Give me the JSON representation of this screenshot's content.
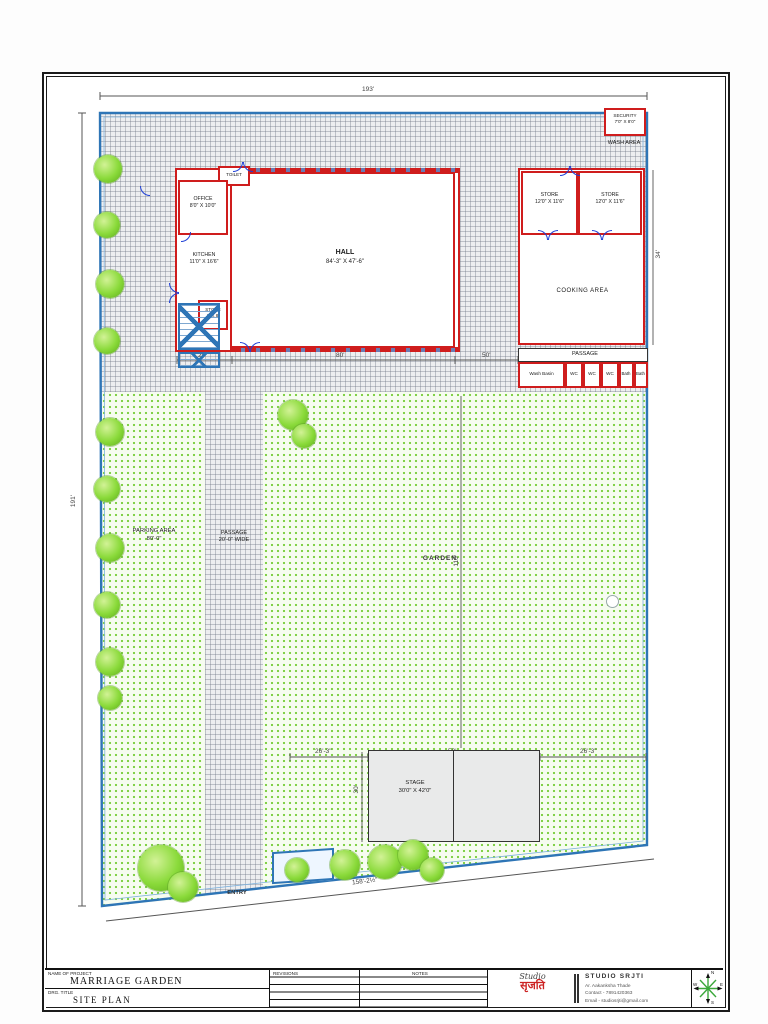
{
  "sheet": {
    "titleblock": {
      "project_label": "NAME OF PROJECT",
      "project_name": "MARRIAGE GARDEN",
      "drawing_label": "DRG. TITLE",
      "drawing_name": "SITE PLAN",
      "revisions_label": "REVISIONS",
      "notes_label": "NOTES",
      "logo_script": "Studio",
      "logo_devanagari": "सृजति",
      "firm_name": "STUDIO SRJTI",
      "architect": "Ar. Aakanksha Thade",
      "contact": "Contact - 7891420363",
      "email": "Email - studiosrjti@gmail.com"
    },
    "compass": {
      "n": "N",
      "e": "E",
      "s": "S",
      "w": "W"
    }
  },
  "plan": {
    "rooms": {
      "office": {
        "name": "OFFICE",
        "dims": "8'0\" X 10'0\""
      },
      "toilet": {
        "name": "TOILET"
      },
      "kitchen": {
        "name": "KITCHEN",
        "dims": "11'0\" X 16'6\""
      },
      "store_small": {
        "name": "STORE",
        "dims": "6' X 8'"
      },
      "hall": {
        "name": "HALL",
        "dims": "84'-3\" X 47'-6\""
      },
      "store_1": {
        "name": "STORE",
        "dims": "12'0\" X 11'6\""
      },
      "store_2": {
        "name": "STORE",
        "dims": "12'0\" X 11'6\""
      },
      "cooking": {
        "name": "COOKING AREA"
      },
      "passage_rear": {
        "name": "PASSAGE"
      },
      "wash_basin": {
        "name": "Wash Basin"
      },
      "wc_1": {
        "name": "WC"
      },
      "wc_2": {
        "name": "WC"
      },
      "wc_3": {
        "name": "WC"
      },
      "bath_1": {
        "name": "Bath"
      },
      "bath_2": {
        "name": "Bath"
      },
      "security": {
        "name": "SECURITY",
        "dims": "7'0\" X 8'0\""
      },
      "wash_area": {
        "name": "WASH AREA"
      },
      "parking": {
        "name": "PARKING AREA",
        "dims": "80'-0\""
      },
      "passage_main": {
        "name": "PASSAGE",
        "dims": "20'-0\" WIDE"
      },
      "garden": {
        "name": "GARDEN"
      },
      "stage": {
        "name": "STAGE",
        "dims": "30'0\" X 42'0\""
      },
      "entry": {
        "name": "ENTRY"
      }
    },
    "dims": {
      "top": "193'",
      "left": "191'",
      "bottom": "158'-2½\"",
      "hall_w": "84'-3\"",
      "hall_h": "47'-6\"",
      "cooking_w": "34'-3\"",
      "cooking_side": "34'",
      "under_a_left": "20'",
      "under_a_mid": "80'",
      "under_a_right": "50'",
      "stage_left": "26'-3\"",
      "stage_w": "50'",
      "stage_right": "26'-3\"",
      "stage_h": "30'",
      "garden_v": "110'"
    }
  }
}
